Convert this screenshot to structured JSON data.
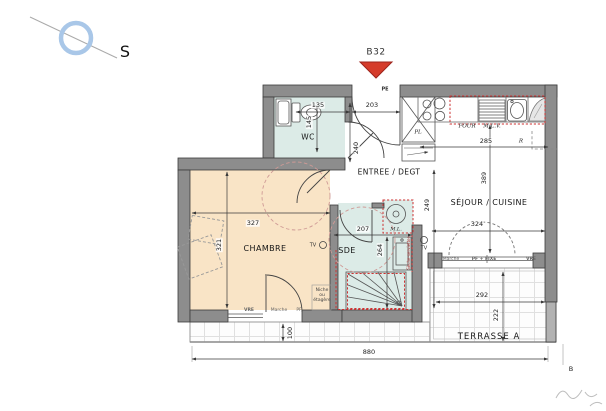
{
  "compass": {
    "label": "S"
  },
  "unit": {
    "label": "B32"
  },
  "rooms": {
    "wc": "WC",
    "entree": "ENTREE / DEGT",
    "sejour": "SÉJOUR / CUISINE",
    "chambre": "CHAMBRE",
    "sde": "SDE",
    "terrasse": "TERRASSE A"
  },
  "fixtures": {
    "entry_door": "PE",
    "closet": "PL",
    "oven": "FOUR",
    "dishwasher": "M.L.V.",
    "washing_machine": "M.L.",
    "fridge": "R",
    "tv": "TV",
    "niche": "Niche\nou\nétagère",
    "towel_rail": "Sèche-serviettes",
    "section_mark": "B"
  },
  "openings": {
    "marche_sejour": "Marche",
    "pf_fixe": "PF + FIXE",
    "vre_sejour": "VRE",
    "vre_chambre": "VRE",
    "marche_chambre": "Marche",
    "pf_chambre": "PF"
  },
  "dimensions_cm": {
    "wc_width": "135",
    "entree_width": "203",
    "wc_depth": "145",
    "entree_depth": "240",
    "kitchen_width": "285",
    "sejour_depth": "389",
    "sejour_width": "324",
    "hall_depth": "249",
    "chambre_width": "327",
    "chambre_depth": "321",
    "sde_width": "207",
    "sde_depth": "264",
    "terrasse_width": "292",
    "terrasse_depth": "222",
    "strip_depth": "100",
    "facade_width": "880"
  },
  "colors": {
    "wall": "#8d8d8d",
    "wet_room_floor": "#dcebe7",
    "bedroom_floor": "#f9e4c6",
    "entry_arrow": "#d53c2b",
    "compass_ring": "#a9c7e8",
    "regulation_dashed": "#cc3333"
  }
}
